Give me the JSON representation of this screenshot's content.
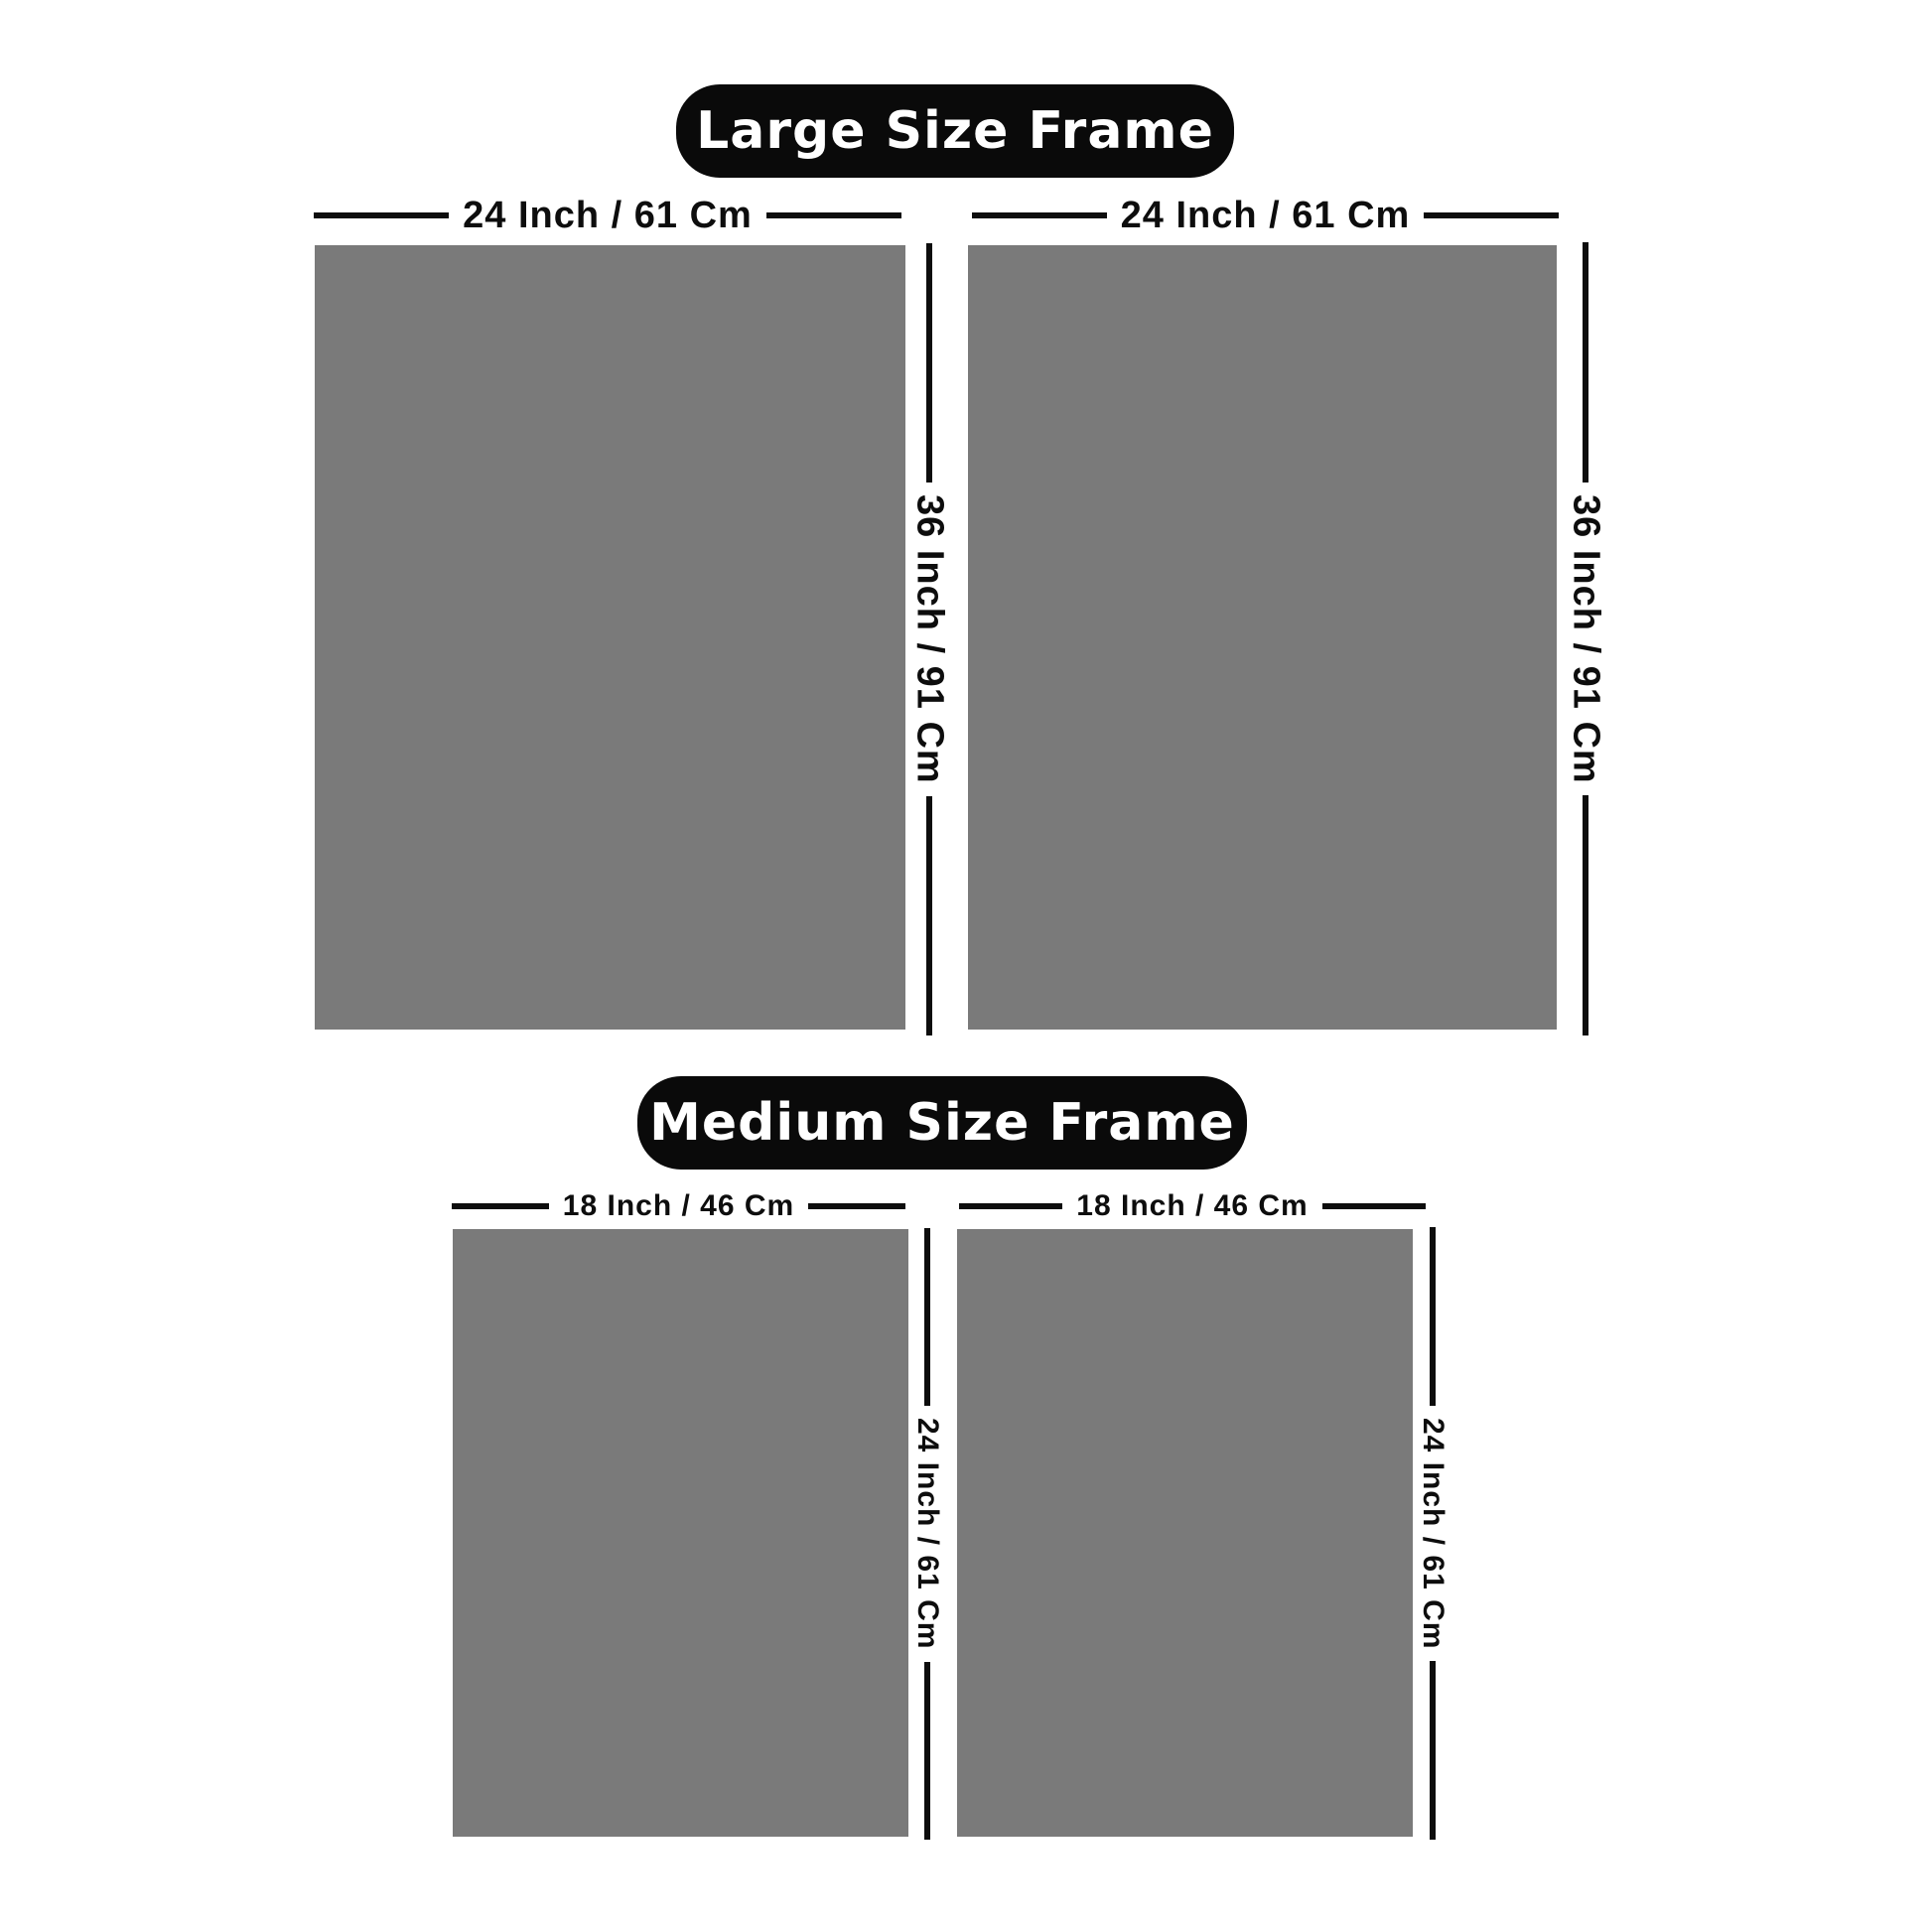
{
  "colors": {
    "background": "#ffffff",
    "badge_bg": "#0a0a0a",
    "badge_text": "#ffffff",
    "frame_fill": "#7a7a7a",
    "dimension_line": "#0d0d0d",
    "label_text": "#0d0d0d"
  },
  "large_section": {
    "title": "Large Size Frame",
    "left_frame": {
      "width_label": "24 Inch / 61 Cm",
      "height_label": "36 Inch / 91 Cm"
    },
    "right_frame": {
      "width_label": "24 Inch / 61 Cm",
      "height_label": "36 Inch / 91 Cm"
    }
  },
  "medium_section": {
    "title": "Medium Size Frame",
    "left_frame": {
      "width_label": "18 Inch / 46 Cm",
      "height_label": "24 Inch / 61 Cm"
    },
    "right_frame": {
      "width_label": "18 Inch / 46 Cm",
      "height_label": "24 Inch / 61 Cm"
    }
  }
}
